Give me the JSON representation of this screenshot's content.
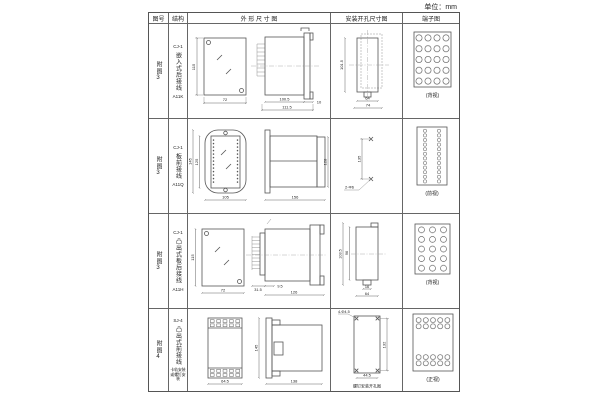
{
  "unit_label": "单位：mm",
  "headers": {
    "fig_no": "图号",
    "structure": "结构",
    "outline": "外 形 尺 寸 图",
    "mounting": "安装开孔尺寸图",
    "terminal": "端子图"
  },
  "rows": [
    {
      "fig_no": "附图3",
      "model": "CJ-1",
      "type": "嵌入式后接线",
      "code": "A11K",
      "dims": {
        "front_h": "115",
        "front_w": "72",
        "d1": "100.5",
        "d2": "111.5",
        "d3": "10"
      },
      "mount": {
        "v1": "101.5",
        "h1": "64",
        "h2": "74"
      },
      "terminal_caption": "(背视)"
    },
    {
      "fig_no": "附图3",
      "model": "CJ-1",
      "type": "板前接线",
      "code": "A11Q",
      "dims": {
        "front_h_outer": "145",
        "front_h_inner": "125",
        "front_w": "105",
        "depth": "156",
        "side_h": "128"
      },
      "mount": {
        "v1": "135",
        "note": "2-Φ6"
      },
      "terminal_caption": "(前视)"
    },
    {
      "fig_no": "附图3",
      "model": "CJ-1",
      "type": "凸出式板后接线",
      "code": "A11H",
      "dims": {
        "front_h": "115",
        "front_w": "72",
        "d1": "31.5",
        "d2": "9.5",
        "d3": "126"
      },
      "mount": {
        "v1": "103.5",
        "v2": "96",
        "h1": "16",
        "h2": "64"
      },
      "terminal_caption": "(背视)"
    },
    {
      "fig_no": "附图4",
      "model": "SJ-4",
      "type": "凸出式前接线",
      "note": "卡轨安装或螺钉安装",
      "dims": {
        "front_w": "64.5",
        "side_h": "145",
        "depth": "138"
      },
      "mount": {
        "note": "4-Φ4.5",
        "v1": "132",
        "h1": "44.5",
        "caption": "螺钉安装开孔图"
      },
      "terminal_caption": "(正视)"
    }
  ]
}
